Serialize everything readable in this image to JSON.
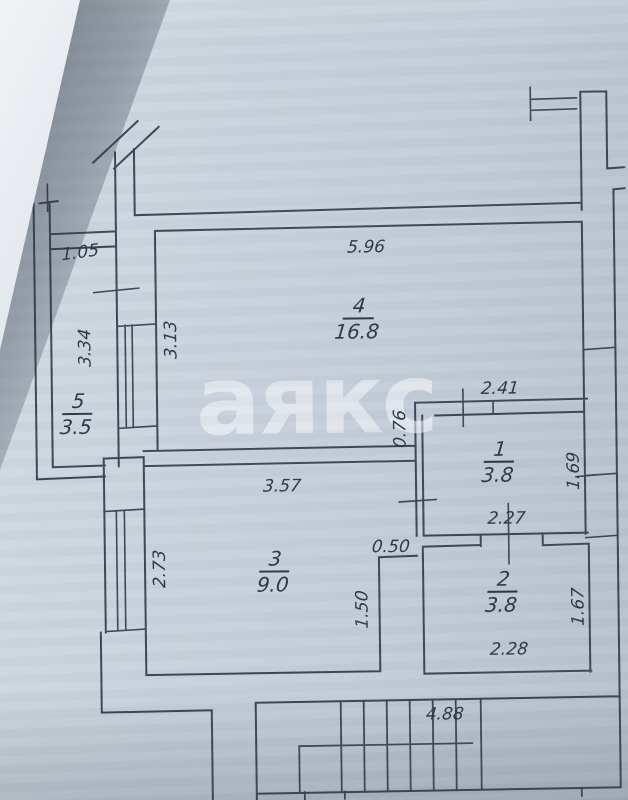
{
  "plan": {
    "watermark": "аякс",
    "rooms": {
      "r1": {
        "number": "1",
        "area": "3.8"
      },
      "r2": {
        "number": "2",
        "area": "3.8"
      },
      "r3": {
        "number": "3",
        "area": "9.0"
      },
      "r4": {
        "number": "4",
        "area": "16.8"
      },
      "r5": {
        "number": "5",
        "area": "3.5"
      }
    },
    "dims": {
      "d1_05": "1.05",
      "d3_34": "3.34",
      "d3_13": "3.13",
      "d5_96": "5.96",
      "d2_41": "2.41",
      "d0_76": "0.76",
      "d1_69": "1.69",
      "d2_27": "2.27",
      "d3_57": "3.57",
      "d0_50": "0.50",
      "d2_73": "2.73",
      "d1_50": "1.50",
      "d1_67": "1.67",
      "d2_28": "2.28",
      "d4_88": "4.88"
    },
    "colors": {
      "paper": "#c9d2dc",
      "wall_line": "#3c4553",
      "ink": "#2d3542",
      "watermark_color": "rgba(249,251,253,0.52)"
    }
  }
}
